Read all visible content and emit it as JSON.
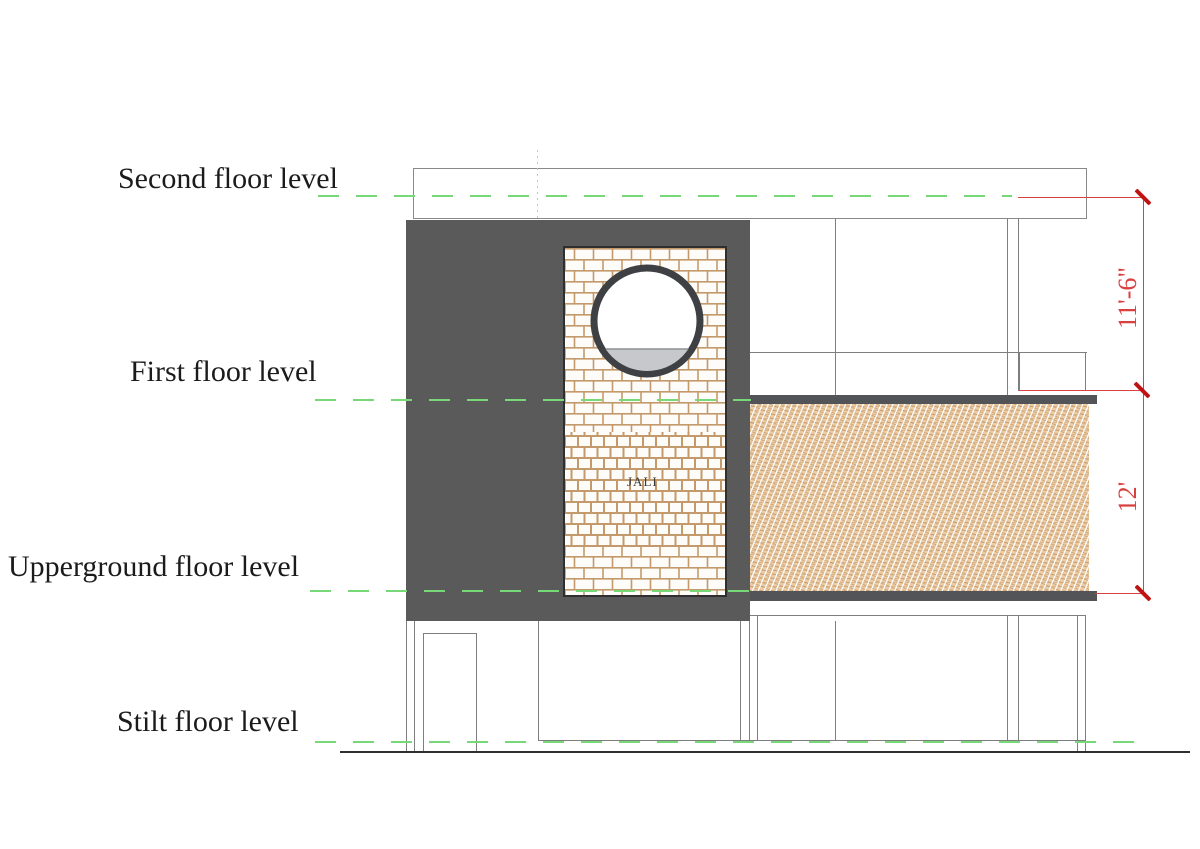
{
  "drawing": {
    "levels": [
      {
        "label": "Second floor level"
      },
      {
        "label": "First floor level"
      },
      {
        "label": "Upperground floor level"
      },
      {
        "label": "Stilt floor level"
      }
    ],
    "dimensions": [
      {
        "label": "11'-6\""
      },
      {
        "label": "12'"
      }
    ],
    "panel_label": "JALI",
    "colors": {
      "level_line_green": "#77d877",
      "dimension_red": "#d94040",
      "tick_red": "#bf1414",
      "wall_dark_gray": "#5a5a5a",
      "slab_band_gray": "#525457",
      "brick_mortar_tan": "#c49a6c",
      "hatch_tan": "#eacda6",
      "window_water_gray": "#c6c8cb"
    }
  }
}
